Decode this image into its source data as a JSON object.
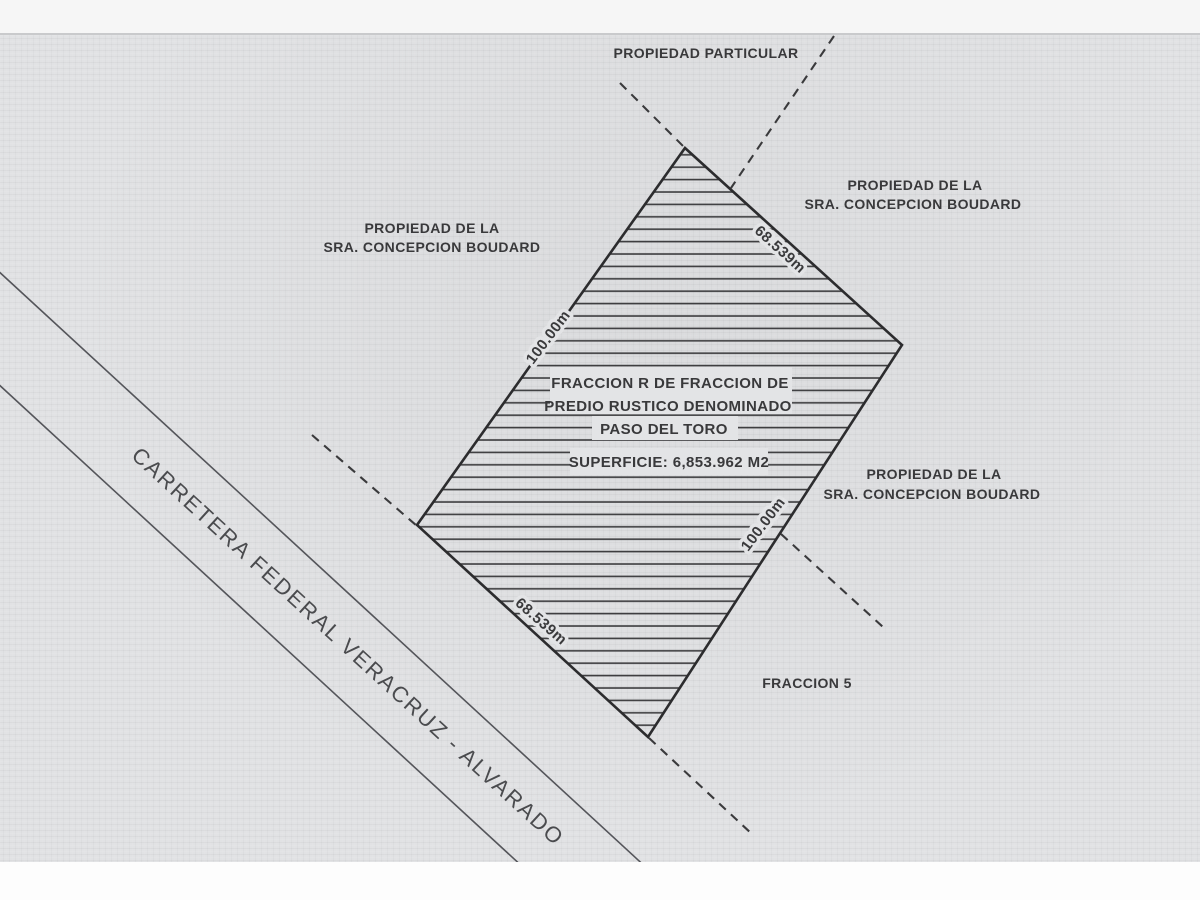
{
  "document": {
    "top_label": "PROPIEDAD PARTICULAR",
    "neighbor_left": {
      "line1": "PROPIEDAD DE LA",
      "line2": "SRA. CONCEPCION BOUDARD"
    },
    "neighbor_top_right": {
      "line1": "PROPIEDAD DE LA",
      "line2": "SRA. CONCEPCION BOUDARD"
    },
    "neighbor_right": {
      "line1": "PROPIEDAD DE LA",
      "line2": "SRA. CONCEPCION BOUDARD"
    },
    "parcel": {
      "title_line1": "FRACCION R DE FRACCION DE",
      "title_line2": "PREDIO RUSTICO DENOMINADO",
      "title_line3": "PASO DEL TORO",
      "area_label": "SUPERFICIE: 6,853.962 M2",
      "dim_top_right": "68.539m",
      "dim_left": "100.00m",
      "dim_right": "100.00m",
      "dim_bottom_left": "68.539m"
    },
    "fraccion_label": "FRACCION 5",
    "road_label": "CARRETERA FEDERAL VERACRUZ - ALVARADO",
    "colors": {
      "paper": "#e1e2e4",
      "ink": "#39393b",
      "road_line": "#54555a"
    }
  }
}
